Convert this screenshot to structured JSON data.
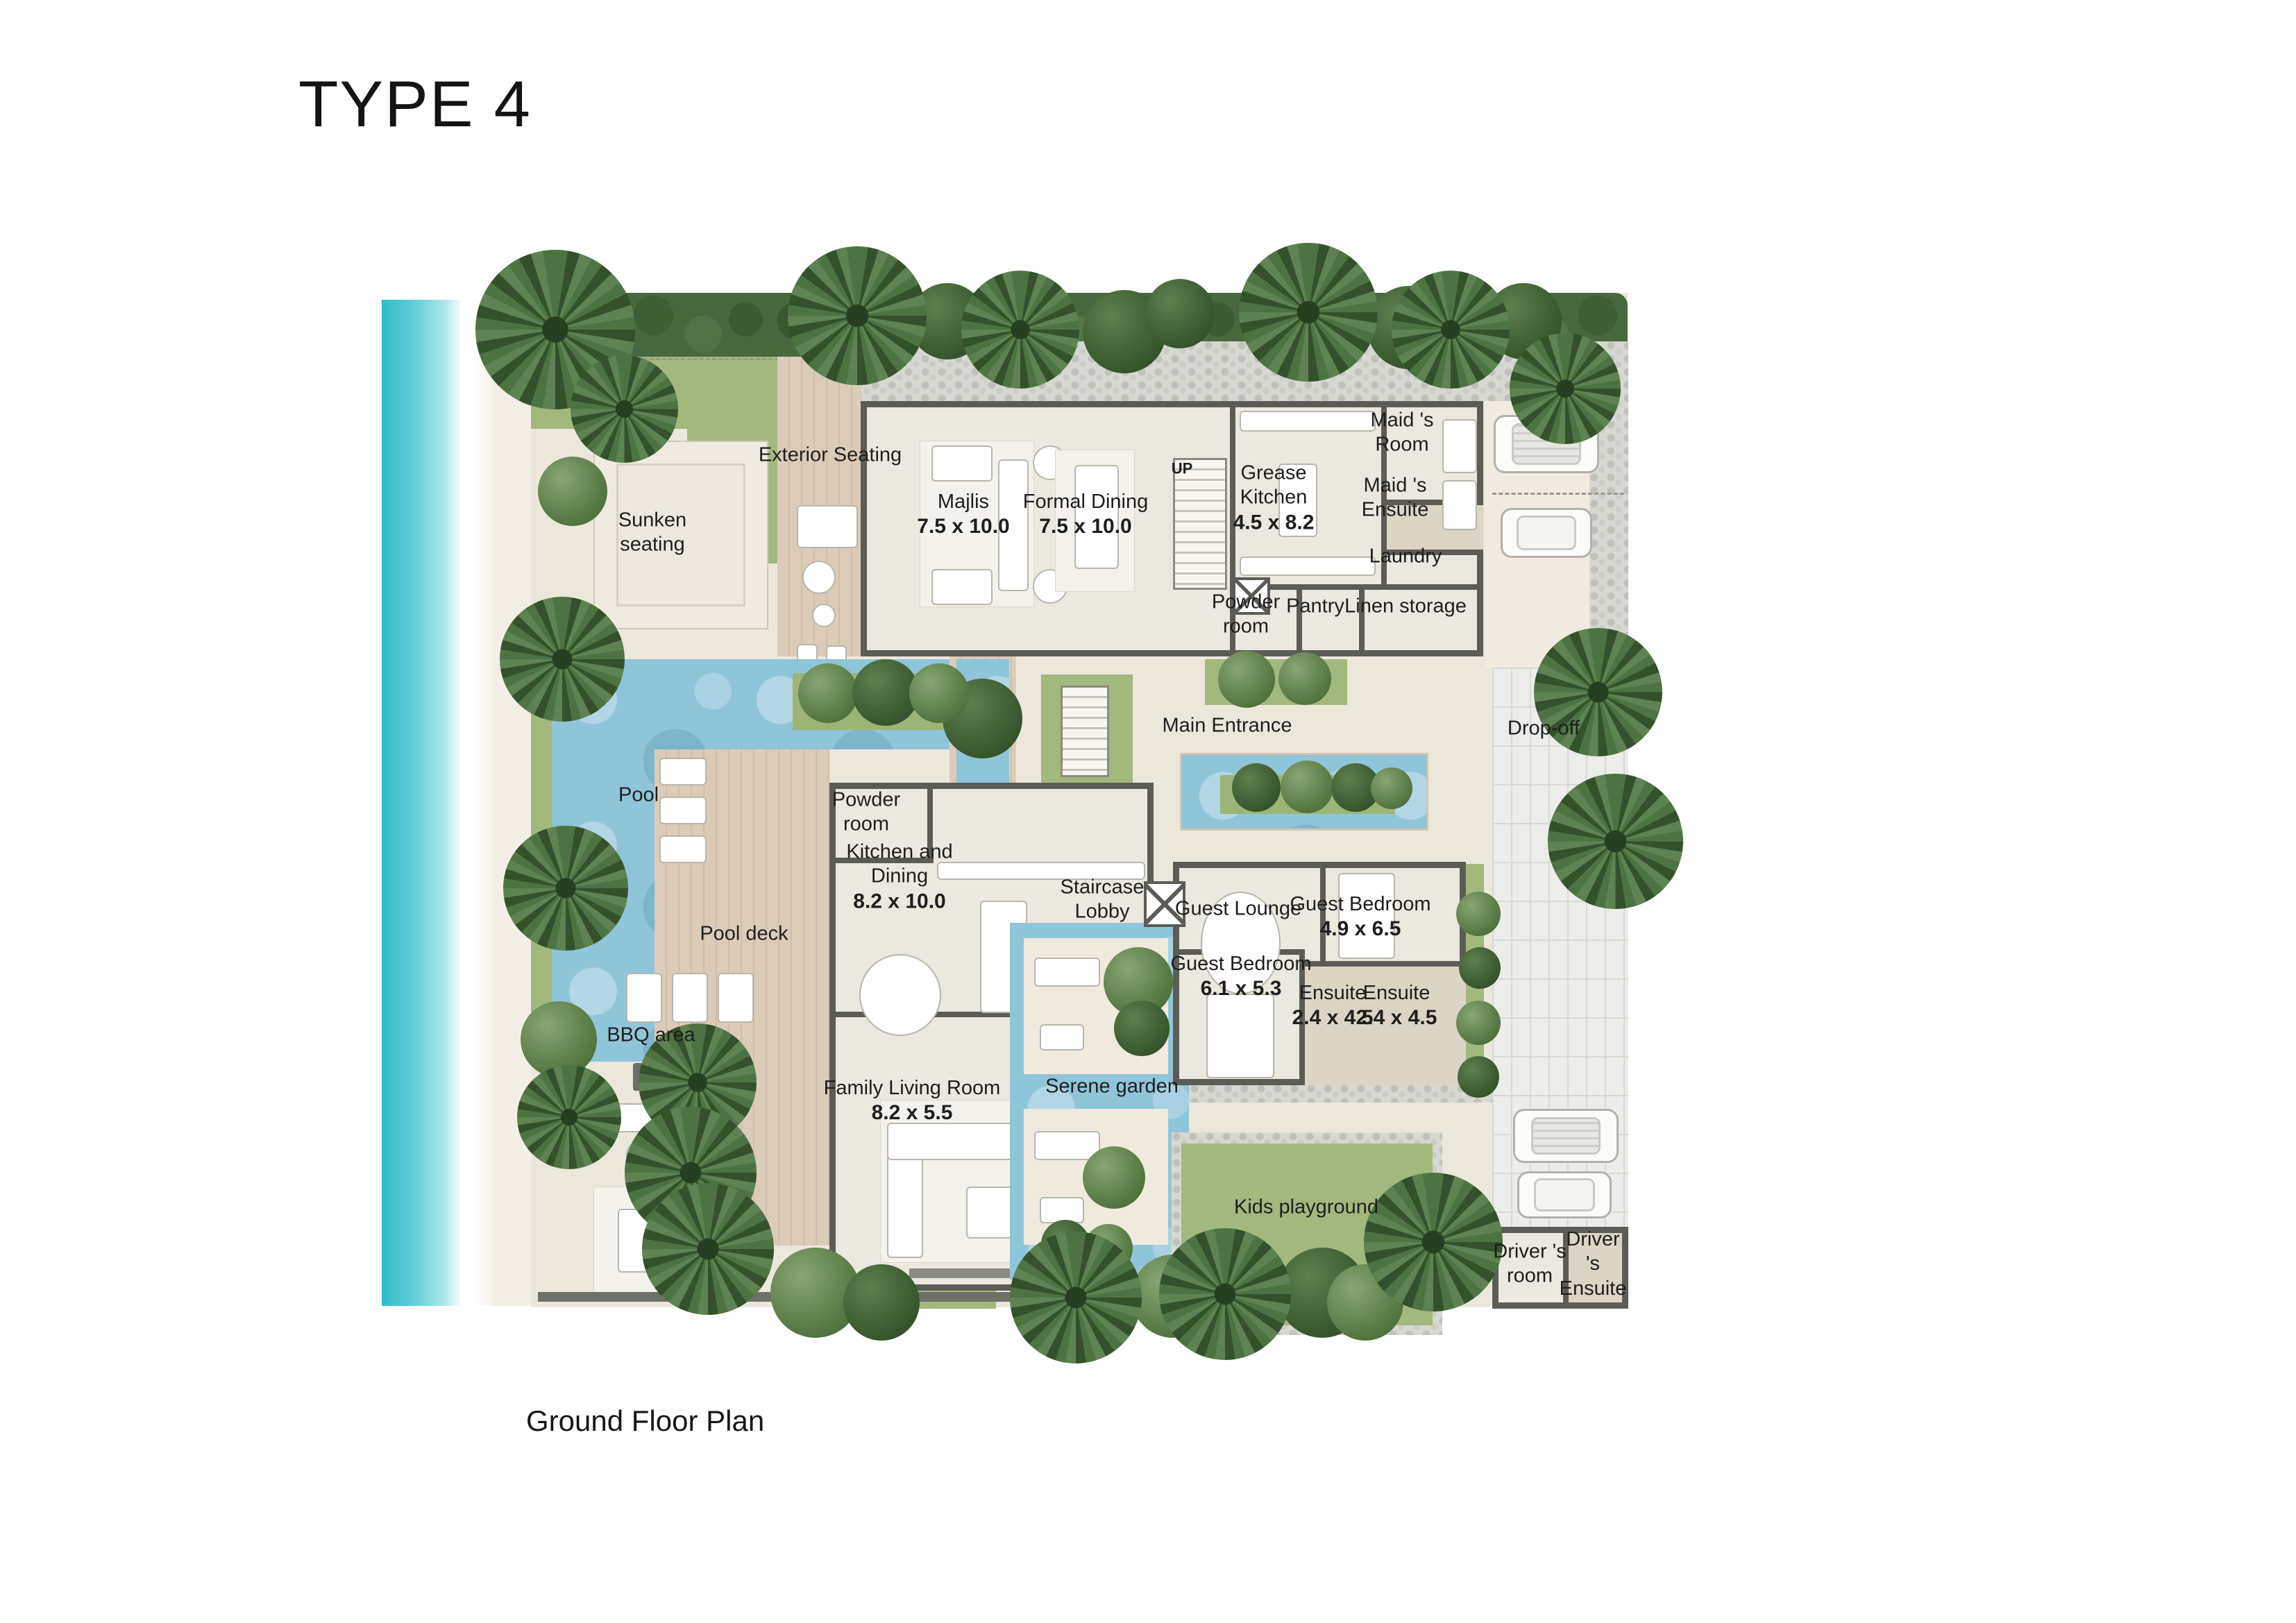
{
  "page": {
    "title": "TYPE 4",
    "caption": "Ground Floor Plan"
  },
  "palette": {
    "sea": "#4fc9d6",
    "beach_sand": "#f3eee5",
    "plot_sand": "#ece7db",
    "lawn": "#a3b87c",
    "hedge": "#49683f",
    "pool_water": "#8fc5d8",
    "deck_wood": "#d8c8b6",
    "wall": "#5c5c57",
    "gravel": "#d8d8d3",
    "paver": "#ececea",
    "text": "#1e1e1e"
  },
  "rooms": {
    "exterior_seating": {
      "label": "Exterior Seating"
    },
    "sunken_seating": {
      "label": "Sunken\nseating"
    },
    "majlis": {
      "label": "Majlis",
      "dim": "7.5 x 10.0"
    },
    "formal_dining": {
      "label": "Formal Dining",
      "dim": "7.5 x 10.0"
    },
    "grease_kitchen": {
      "label": "Grease\nKitchen",
      "dim": "4.5 x 8.2"
    },
    "maids_room": {
      "label": "Maid 's\nRoom"
    },
    "maids_ensuite": {
      "label": "Maid 's\nEnsuite"
    },
    "laundry": {
      "label": "Laundry"
    },
    "powder_room_service": {
      "label": "Powder\nroom"
    },
    "pantry": {
      "label": "Pantry"
    },
    "linen_storage": {
      "label": "Linen storage"
    },
    "main_entrance": {
      "label": "Main Entrance"
    },
    "drop_off": {
      "label": "Drop-off"
    },
    "pool": {
      "label": "Pool"
    },
    "pool_deck": {
      "label": "Pool deck"
    },
    "powder_room": {
      "label": "Powder\nroom"
    },
    "kitchen_dining": {
      "label": "Kitchen and\nDining",
      "dim": "8.2 x 10.0"
    },
    "staircase_lobby": {
      "label": "Staircase\nLobby"
    },
    "guest_lounge": {
      "label": "Guest Lounge"
    },
    "guest_bedroom_1": {
      "label": "Guest Bedroom",
      "dim": "4.9 x 6.5"
    },
    "guest_bedroom_2": {
      "label": "Guest Bedroom",
      "dim": "6.1 x 5.3"
    },
    "ensuite_1": {
      "label": "Ensuite",
      "dim": "2.4 x 4.5"
    },
    "ensuite_2": {
      "label": "Ensuite",
      "dim": "2.4 x 4.5"
    },
    "bbq_area": {
      "label": "BBQ area"
    },
    "family_living_room": {
      "label": "Family Living Room",
      "dim": "8.2 x 5.5"
    },
    "serene_garden": {
      "label": "Serene garden"
    },
    "kids_playground": {
      "label": "Kids playground"
    },
    "drivers_room": {
      "label": "Driver 's\nroom"
    },
    "drivers_ensuite": {
      "label": "Driver 's\nEnsuite"
    }
  },
  "annotations": {
    "stair_up": "UP"
  }
}
